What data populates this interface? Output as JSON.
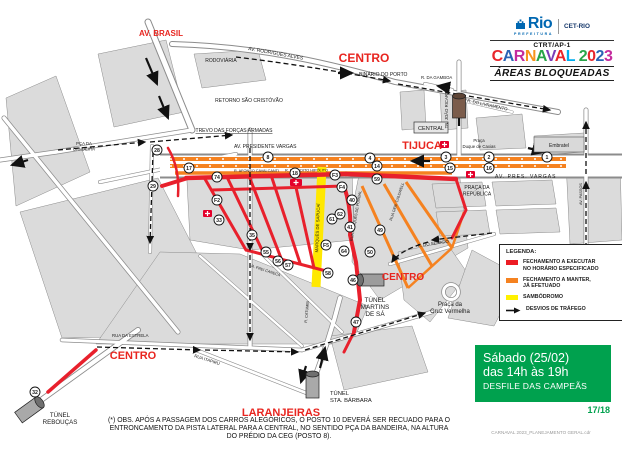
{
  "header": {
    "logo_text": "Rio",
    "logo_sub": "PREFEITURA",
    "agency": "CET-RIO",
    "unit": "CTRT/AP-1",
    "title": "CARNAVAL 2023",
    "title_colors": [
      "#E8262C",
      "#2A64B5",
      "#C42B9E",
      "#F7941D",
      "#29A449",
      "#7B3DB8",
      "#E8262C",
      "#00AEEF",
      "#F7941D",
      "#29A449",
      "#E8262C",
      "#2A64B5",
      "#C42B9E"
    ],
    "subtitle": "ÁREAS BLOQUEADAS"
  },
  "legend": {
    "title": "LEGENDA:",
    "items": [
      {
        "swatch": "#EC1C24",
        "kind": "box",
        "label_line1": "FECHAMENTO A EXECUTAR",
        "label_line2": "NO HORÁRIO ESPECIFICADO"
      },
      {
        "swatch": "#F58220",
        "kind": "box",
        "label_line1": "FECHAMENTO A MANTER,",
        "label_line2": "JÁ EFETUADO"
      },
      {
        "swatch": "#FFF100",
        "kind": "box",
        "label_line1": "SAMBÓDROMO",
        "label_line2": ""
      },
      {
        "swatch": "#111111",
        "kind": "arrow",
        "label_line1": "DESVIOS DE TRÁFEGO",
        "label_line2": ""
      }
    ]
  },
  "schedule": {
    "line1": "Sábado (25/02)",
    "line2": "das 14h às 19h",
    "line3": "DESFILE DAS CAMPEÃS",
    "page": "17/18"
  },
  "footnote": {
    "line1": "(*) OBS. APÓS A PASSAGEM DOS CARROS ALEGÓRICOS, O POSTO 10 DEVERÁ SER RECUADO PARA O",
    "line2": "ENTRONCAMENTO DA PISTA LATERAL PARA A CENTRAL, NO SENTIDO PÇA DA BANDEIRA, NA ALTURA",
    "line3": "DO PRÉDIO DA CEG (POSTO 8)."
  },
  "file_label": "CARNAVAL 2023_PLANEJAMENTO GERAL.cdr",
  "map": {
    "districts": {
      "av_brasil": "AV. BRASIL",
      "centro_norte": "CENTRO",
      "tijuca": "TIJUCA",
      "centro_leste": "CENTRO",
      "centro_sul": "CENTRO",
      "laranjeiras": "LARANJEIRAS"
    },
    "places": {
      "rodoviaria": "RODOVIÁRIA",
      "binario": "BINÁRIO DO PORTO",
      "retorno": "RETORNO SÃO CRISTÓVÃO",
      "trevo": "TREVO DAS FORÇAS ARMADAS",
      "central": "CENTRAL",
      "duque1": "Praça",
      "duque2": "Duque de Caxias",
      "embratel": "Embratel",
      "republica1": "PRAÇA DA",
      "republica2": "REPÚBLICA",
      "martins1": "TÚNEL",
      "martins2": "MARTINS",
      "martins3": "DE SÁ",
      "cruz1": "Praça da",
      "cruz2": "Cruz Vermelha",
      "sta_barbara1": "TÚNEL",
      "sta_barbara2": "STA. BÁRBARA",
      "reboucas1": "TÚNEL",
      "reboucas2": "REBOUÇAS",
      "bandeira1": "PÇA DA",
      "bandeira2": "BANDEIRA",
      "tn_joao": "TN. JOÃO RICARDO"
    },
    "streets": {
      "pres_vargas": "AV. PRESIDENTE VARGAS",
      "rodrigues_alves": "AV. RODRIGUES ALVES",
      "pres_vargas_r": "AV.  PRES.  VARGAS",
      "gamboa": "R. DA GAMBOA",
      "livramento": "R. DO LIVRAMENTO",
      "senado": "R. DO SENADO",
      "estrela": "RUA DA ESTRELA",
      "itapiru": "RUA ITAPIRU",
      "sapucai": "MARQUÊS DE SAPUCAÍ",
      "afonso": "R. AFONSO CAVALCANTI",
      "benedito": "R. BENEDITO HIPÓLITO",
      "pombal": "RUA MARQUÊS DE POMBAL",
      "frei_caneca": "R. FREI CANECA",
      "catumbi": "R. CATUMBI",
      "caldwell": "RUA GEN. CALDWELL",
      "passos": "AV. PASSOS"
    },
    "markers": [
      {
        "id": "1",
        "x": 547,
        "y": 157
      },
      {
        "id": "2",
        "x": 489,
        "y": 157
      },
      {
        "id": "3",
        "x": 446,
        "y": 157
      },
      {
        "id": "4",
        "x": 370,
        "y": 158
      },
      {
        "id": "8",
        "x": 268,
        "y": 157
      },
      {
        "id": "14",
        "x": 377,
        "y": 166
      },
      {
        "id": "15",
        "x": 450,
        "y": 168
      },
      {
        "id": "16",
        "x": 489,
        "y": 168
      },
      {
        "id": "17",
        "x": 189,
        "y": 168
      },
      {
        "id": "18",
        "x": 295,
        "y": 173
      },
      {
        "id": "28",
        "x": 157,
        "y": 150
      },
      {
        "id": "29",
        "x": 153,
        "y": 186
      },
      {
        "id": "32",
        "x": 35,
        "y": 392
      },
      {
        "id": "33",
        "x": 219,
        "y": 220
      },
      {
        "id": "35",
        "x": 252,
        "y": 235
      },
      {
        "id": "40",
        "x": 352,
        "y": 200
      },
      {
        "id": "41",
        "x": 350,
        "y": 227
      },
      {
        "id": "46",
        "x": 353,
        "y": 280
      },
      {
        "id": "47",
        "x": 356,
        "y": 322
      },
      {
        "id": "49",
        "x": 380,
        "y": 230
      },
      {
        "id": "50",
        "x": 370,
        "y": 252
      },
      {
        "id": "55",
        "x": 266,
        "y": 252
      },
      {
        "id": "56",
        "x": 278,
        "y": 261
      },
      {
        "id": "57",
        "x": 288,
        "y": 265
      },
      {
        "id": "58",
        "x": 328,
        "y": 273
      },
      {
        "id": "59",
        "x": 377,
        "y": 179
      },
      {
        "id": "61",
        "x": 332,
        "y": 219
      },
      {
        "id": "62",
        "x": 340,
        "y": 214
      },
      {
        "id": "64",
        "x": 344,
        "y": 251
      },
      {
        "id": "74",
        "x": 217,
        "y": 177
      },
      {
        "id": "F2",
        "x": 217,
        "y": 200
      },
      {
        "id": "F3",
        "x": 335,
        "y": 175
      },
      {
        "id": "F4",
        "x": 342,
        "y": 187
      },
      {
        "id": "F5",
        "x": 326,
        "y": 245
      }
    ],
    "colors": {
      "closure_red": "#E8202C",
      "closure_orange": "#F58220",
      "sambodromo_yellow": "#FFE800",
      "schedule_green": "#00A14E"
    }
  }
}
